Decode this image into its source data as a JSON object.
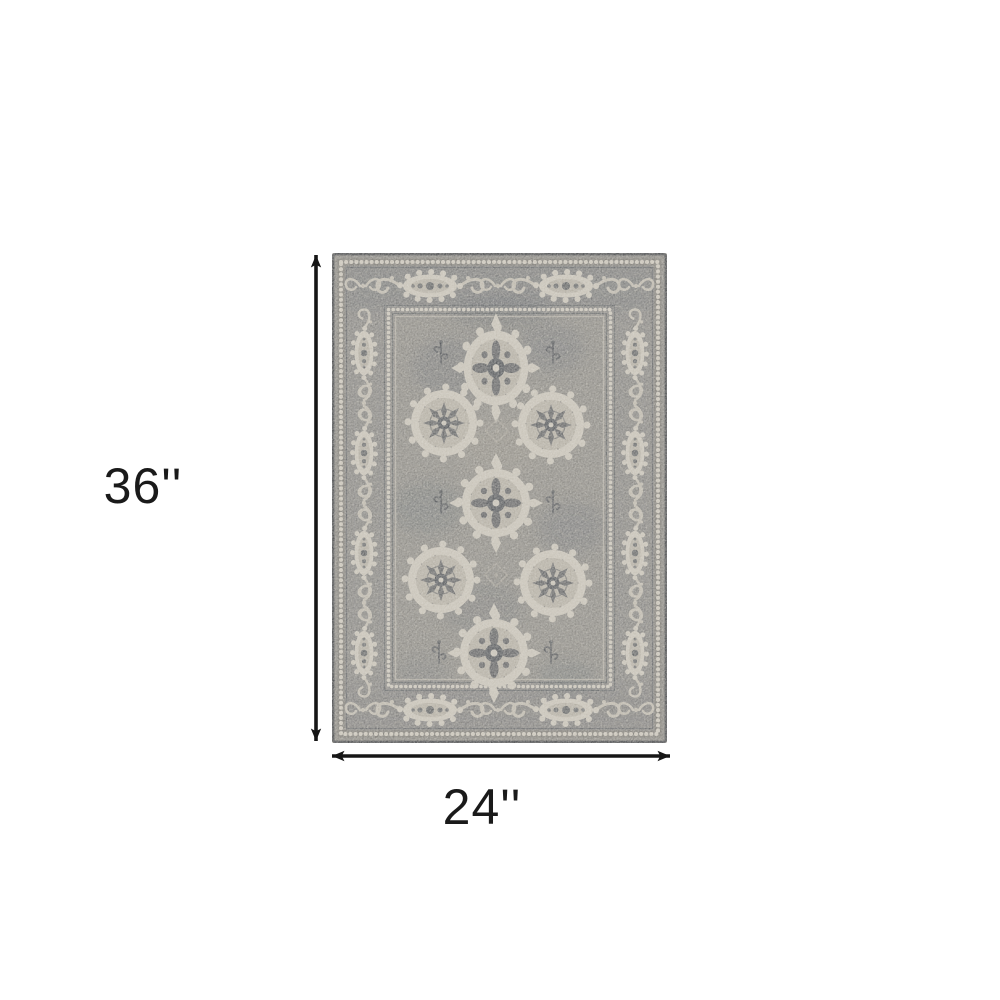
{
  "diagram": {
    "height_label": "36''",
    "width_label": "24''",
    "subject": "grey-traditional-medallion-area-rug"
  },
  "colors": {
    "page_background": "#ffffff",
    "dimension_ink": "#161616",
    "rug_base": "#8c8a85",
    "rug_border_band": "#73767a",
    "rug_pattern_light": "#c7c2b7",
    "rug_pattern_dark": "#54575b",
    "rug_edge": "#494b4e"
  }
}
